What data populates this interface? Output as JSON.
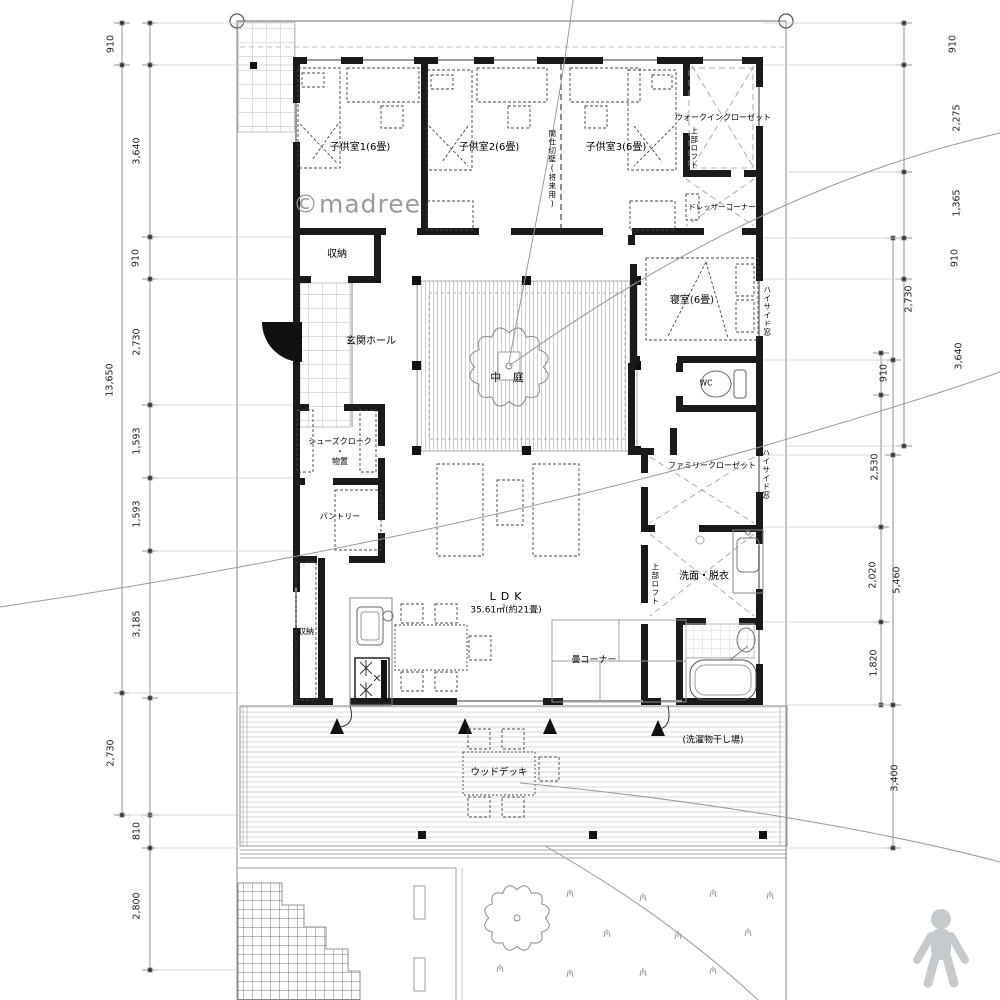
{
  "watermark": "©madree",
  "labels": {
    "kids1": "子供室1(6畳)",
    "kids2": "子供室2(6畳)",
    "kids3": "子供室3(6畳)",
    "partition": "間仕切壁(将来用)",
    "wic": "ウォークインクローゼット",
    "loft": "上部ロフト",
    "dresser": "ドレッサーコーナー",
    "bedroom": "寝室(6畳)",
    "highside_window": "ハイサイド窓",
    "wc": "WC",
    "family_closet": "ファミリークローゼット",
    "washroom": "洗面・脱衣",
    "storage": "収納",
    "entrance": "玄関ホール",
    "courtyard": "中 庭",
    "shoes": "シューズクローク\n・\n物置",
    "pantry": "パントリー",
    "ldk": "LDK",
    "ldk_area": "35.61㎡(約21畳)",
    "tatami": "畳コーナー",
    "wood_deck": "ウッドデッキ",
    "laundry": "(洗濯物干し場)"
  },
  "dims": {
    "left": [
      "910",
      "3,640",
      "910",
      "2,730",
      "1,593",
      "1,593",
      "3,185",
      "2,730",
      "810",
      "2,800"
    ],
    "left_total": "13,650",
    "right": [
      "910",
      "2,275",
      "1,365",
      "910",
      "2,730",
      "3,640",
      "910",
      "2,530",
      "2,020",
      "5,460",
      "1,820",
      "3,400"
    ]
  },
  "colors": {
    "wall": "#1a1a1a",
    "dim_line": "#777777",
    "stripe": "#c8c8c8",
    "watermark": "#9b9b9b",
    "logo": "#c6cacd"
  }
}
